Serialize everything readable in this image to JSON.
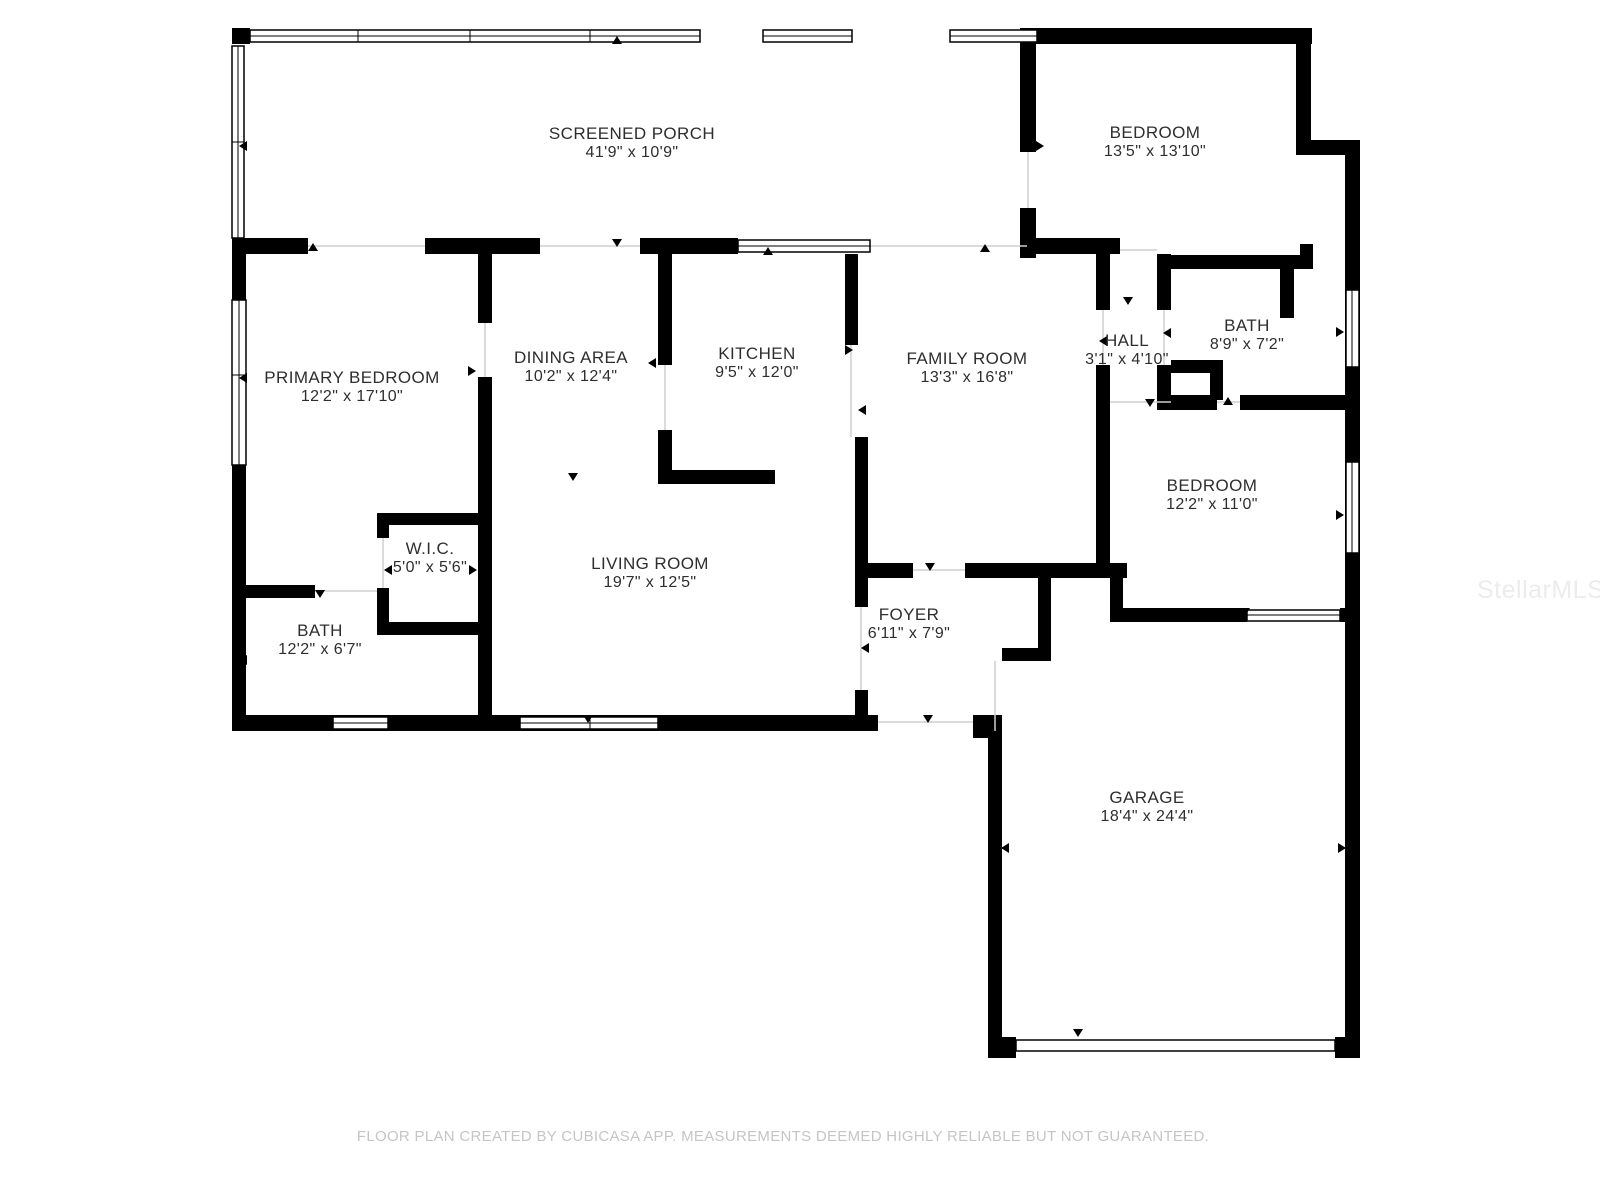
{
  "plan": {
    "rooms": [
      {
        "name": "SCREENED PORCH",
        "dims": "41'9\" x 10'9\""
      },
      {
        "name": "BEDROOM",
        "dims": "13'5\" x 13'10\""
      },
      {
        "name": "PRIMARY BEDROOM",
        "dims": "12'2\" x 17'10\""
      },
      {
        "name": "DINING AREA",
        "dims": "10'2\" x 12'4\""
      },
      {
        "name": "KITCHEN",
        "dims": "9'5\" x 12'0\""
      },
      {
        "name": "FAMILY ROOM",
        "dims": "13'3\" x 16'8\""
      },
      {
        "name": "HALL",
        "dims": "3'1\" x 4'10\""
      },
      {
        "name": "BATH",
        "dims": "8'9\" x 7'2\""
      },
      {
        "name": "BEDROOM",
        "dims": "12'2\" x 11'0\""
      },
      {
        "name": "W.I.C.",
        "dims": "5'0\" x 5'6\""
      },
      {
        "name": "LIVING ROOM",
        "dims": "19'7\" x 12'5\""
      },
      {
        "name": "BATH",
        "dims": "12'2\" x 6'7\""
      },
      {
        "name": "FOYER",
        "dims": "6'11\" x 7'9\""
      },
      {
        "name": "GARAGE",
        "dims": "18'4\" x 24'4\""
      }
    ],
    "watermark": "StellarMLS",
    "footer": "FLOOR PLAN CREATED BY CUBICASA APP. MEASUREMENTS DEEMED HIGHLY RELIABLE BUT NOT GUARANTEED."
  },
  "colors": {
    "wall": "#000000",
    "text": "#2e2e2e",
    "footer": "#c5c5c5",
    "watermark": "#ececec"
  }
}
